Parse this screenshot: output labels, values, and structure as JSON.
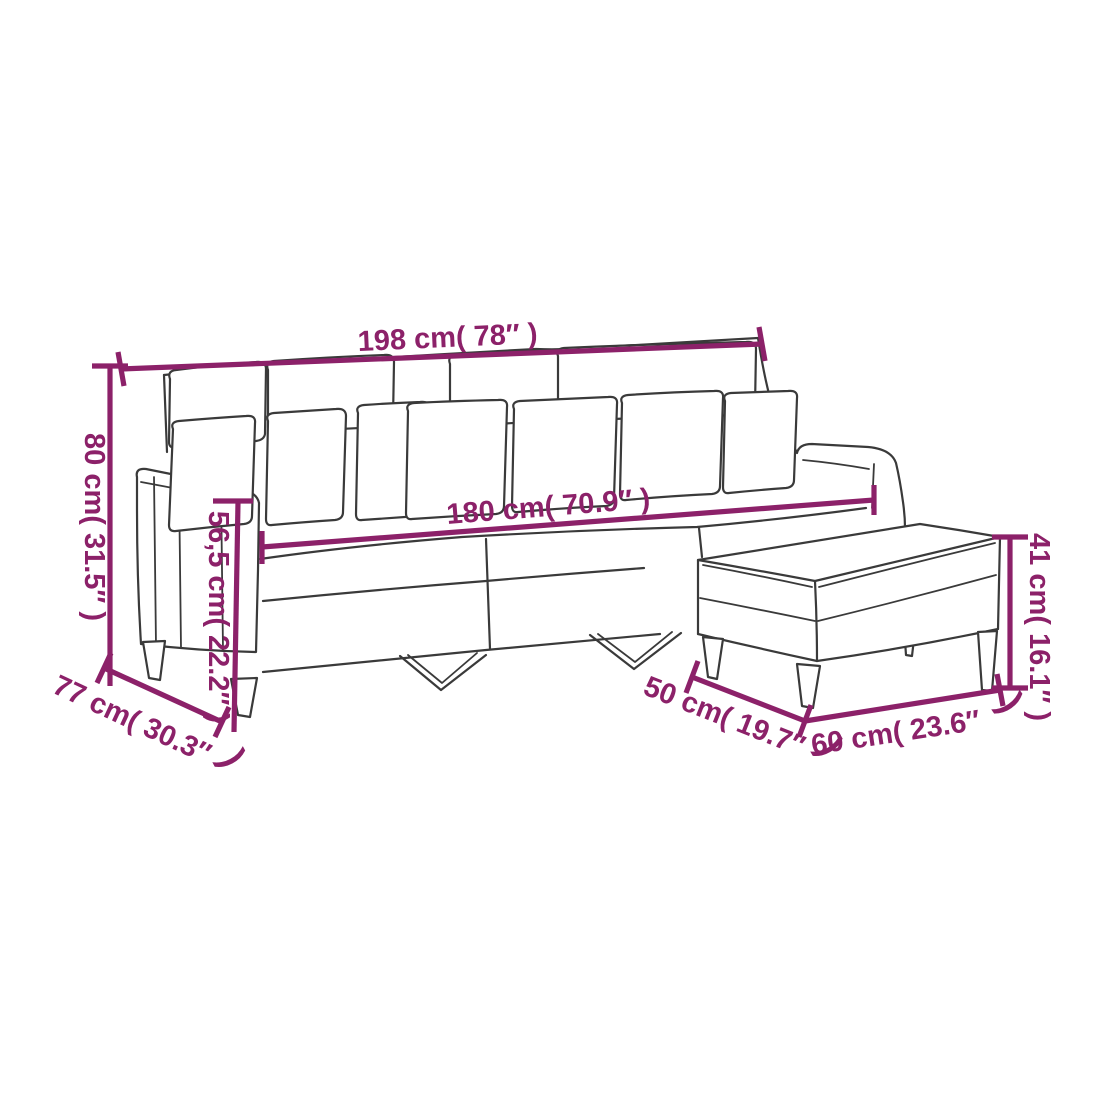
{
  "diagram": {
    "subject": "3-seater sofa with footstool dimension drawing",
    "accent_color": "#8C2169",
    "outline_color": "#3A3A3A",
    "background_color": "#FFFFFF",
    "dimensions": {
      "overall_width": "198 cm( 78″  )",
      "overall_height": "80 cm( 31.5″  )",
      "seat_height": "56,5 cm( 22.2″  )",
      "overall_depth": "77 cm( 30.3″",
      "overall_depth_close": ")",
      "seat_width": "180 cm( 70.9″  )",
      "stool_height": "41 cm( 16.1″  )",
      "stool_depth": "50 cm( 19.7″",
      "stool_depth_close": ")",
      "stool_width": "60 cm( 23.6″",
      "stool_width_close": ")"
    }
  }
}
